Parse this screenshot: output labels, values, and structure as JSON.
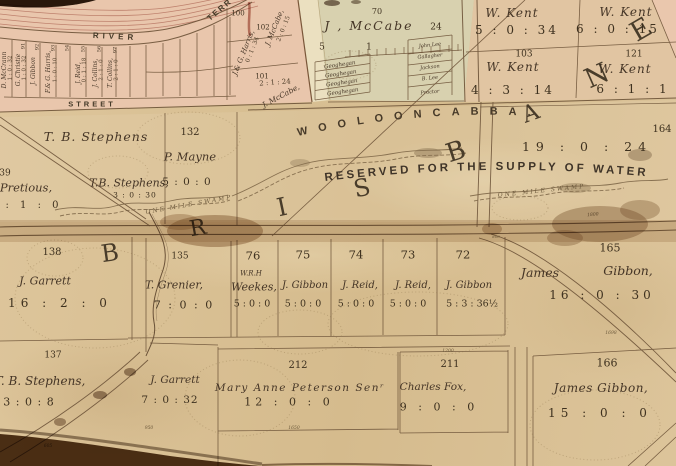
{
  "map": {
    "arc_labels": {
      "suburb": "WOOLOONCABBA.",
      "reserve": "RESERVED  FOR  THE  SUPPLY  OF  WATER",
      "swamp_left": "ONE  MILE  SWAMP",
      "swamp_right": "ONE  MILE  SWAMP"
    },
    "region_letters": [
      {
        "ch": "B",
        "x": 110,
        "y": 253,
        "r": -8,
        "fs": 24
      },
      {
        "ch": "R",
        "x": 198,
        "y": 229,
        "r": -10,
        "fs": 22
      },
      {
        "ch": "I",
        "x": 282,
        "y": 207,
        "r": -12,
        "fs": 25
      },
      {
        "ch": "S",
        "x": 362,
        "y": 188,
        "r": -12,
        "fs": 24
      },
      {
        "ch": "B",
        "x": 456,
        "y": 152,
        "r": -18,
        "fs": 26
      },
      {
        "ch": "A",
        "x": 531,
        "y": 114,
        "r": -20,
        "fs": 23
      },
      {
        "ch": "N",
        "x": 597,
        "y": 76,
        "r": -24,
        "fs": 27
      },
      {
        "ch": "E",
        "x": 641,
        "y": 30,
        "r": -30,
        "fs": 27
      }
    ],
    "labels": [
      {
        "t": "RIVER",
        "x": 115,
        "y": 37,
        "fs": 8,
        "r": 3,
        "ls": 4,
        "cls": "street",
        "n": "street-river"
      },
      {
        "t": "TERR",
        "x": 220,
        "y": 10,
        "fs": 8,
        "r": -40,
        "ls": 2,
        "cls": "street",
        "n": "street-terrace"
      },
      {
        "t": "STREET",
        "x": 92,
        "y": 104,
        "fs": 7.5,
        "ls": 3,
        "cls": "street",
        "n": "street-label"
      },
      {
        "t": "D. McCrann",
        "x": 5,
        "y": 70,
        "fs": 6,
        "r": -90,
        "cls": "owner"
      },
      {
        "t": "1 : 0 : 32",
        "x": 11,
        "y": 68,
        "fs": 5.5,
        "r": -90,
        "cls": "tiny"
      },
      {
        "t": "G. Christie",
        "x": 19,
        "y": 70,
        "fs": 6,
        "r": -90,
        "cls": "owner"
      },
      {
        "t": "1 : 0 : 32",
        "x": 25,
        "y": 68,
        "fs": 5.5,
        "r": -90,
        "cls": "tiny"
      },
      {
        "t": "91",
        "x": 24,
        "y": 46,
        "fs": 5,
        "r": -90,
        "cls": "num"
      },
      {
        "t": "J. Gibbon",
        "x": 34,
        "y": 71,
        "fs": 6,
        "r": -90,
        "cls": "owner"
      },
      {
        "t": "92",
        "x": 38,
        "y": 47,
        "fs": 5,
        "r": -90,
        "cls": "num"
      },
      {
        "t": "F.& G. Harris,",
        "x": 49,
        "y": 72,
        "fs": 6,
        "r": -90,
        "cls": "owner"
      },
      {
        "t": "1 : 0 : 10",
        "x": 56,
        "y": 70,
        "fs": 5.5,
        "r": -90,
        "cls": "tiny"
      },
      {
        "t": "93",
        "x": 54,
        "y": 48,
        "fs": 5,
        "r": -90,
        "cls": "num"
      },
      {
        "t": "54",
        "x": 68,
        "y": 48,
        "fs": 5,
        "r": -90,
        "cls": "num"
      },
      {
        "t": "J. Reid,",
        "x": 79,
        "y": 73,
        "fs": 6,
        "r": -90,
        "cls": "owner"
      },
      {
        "t": "0 : 1 : 18",
        "x": 85,
        "y": 70,
        "fs": 5.5,
        "r": -90,
        "cls": "tiny"
      },
      {
        "t": "55",
        "x": 84,
        "y": 49,
        "fs": 5,
        "r": -90,
        "cls": "num"
      },
      {
        "t": "J. Collins,",
        "x": 96,
        "y": 73,
        "fs": 6,
        "r": -90,
        "cls": "owner"
      },
      {
        "t": "2 : 1 : 0",
        "x": 102,
        "y": 70,
        "fs": 5.5,
        "r": -90,
        "cls": "tiny"
      },
      {
        "t": "56",
        "x": 100,
        "y": 49,
        "fs": 5,
        "r": -90,
        "cls": "num"
      },
      {
        "t": "T. Collins,",
        "x": 111,
        "y": 73,
        "fs": 6,
        "r": -90,
        "cls": "owner"
      },
      {
        "t": "2 : 1 : 0",
        "x": 117,
        "y": 70,
        "fs": 5.5,
        "r": -90,
        "cls": "tiny"
      },
      {
        "t": "97",
        "x": 116,
        "y": 50,
        "fs": 5,
        "r": -90,
        "cls": "num"
      },
      {
        "t": "100",
        "x": 238,
        "y": 14,
        "fs": 7,
        "cls": "num"
      },
      {
        "t": "J.& G. Harris,",
        "x": 244,
        "y": 53,
        "fs": 7,
        "r": -68,
        "cls": "owner"
      },
      {
        "t": "0 : 1 : 34",
        "x": 253,
        "y": 50,
        "fs": 6,
        "r": -68,
        "cls": "tiny"
      },
      {
        "t": "102",
        "x": 263,
        "y": 28,
        "fs": 7,
        "cls": "num"
      },
      {
        "t": "J. McCabe,",
        "x": 275,
        "y": 28,
        "fs": 7,
        "r": -68,
        "cls": "owner"
      },
      {
        "t": "2 : 0 : 15",
        "x": 284,
        "y": 29,
        "fs": 6,
        "r": -68,
        "cls": "tiny"
      },
      {
        "t": "101",
        "x": 262,
        "y": 77,
        "fs": 7,
        "cls": "num"
      },
      {
        "t": "2 : 1 : 24",
        "x": 275,
        "y": 83,
        "fs": 7,
        "r": -4,
        "cls": "tiny"
      },
      {
        "t": "J. McCabe,",
        "x": 281,
        "y": 96,
        "fs": 7.5,
        "r": -28,
        "cls": "owner"
      },
      {
        "t": "70",
        "x": 377,
        "y": 12,
        "fs": 8,
        "cls": "num"
      },
      {
        "t": "J , McCabe",
        "x": 369,
        "y": 26,
        "fs": 12.5,
        "ls": 2,
        "cls": "owner",
        "n": "j-mccabe-parcel-owner"
      },
      {
        "t": "5",
        "x": 322,
        "y": 48,
        "fs": 9,
        "cls": "num"
      },
      {
        "t": "1",
        "x": 369,
        "y": 48,
        "fs": 9,
        "cls": "num"
      },
      {
        "t": "24",
        "x": 436,
        "y": 28,
        "fs": 9,
        "cls": "num"
      },
      {
        "t": "Geoghegan",
        "x": 340,
        "y": 66,
        "fs": 5.5,
        "r": -8,
        "cls": "owner"
      },
      {
        "t": "Geoghegan",
        "x": 341,
        "y": 75,
        "fs": 5.5,
        "r": -8,
        "cls": "owner"
      },
      {
        "t": "Geoghegan",
        "x": 342,
        "y": 84,
        "fs": 5.5,
        "r": -8,
        "cls": "owner"
      },
      {
        "t": "Geoghegan",
        "x": 343,
        "y": 93,
        "fs": 5.5,
        "r": -8,
        "cls": "owner"
      },
      {
        "t": "John Lee",
        "x": 430,
        "y": 46,
        "fs": 5,
        "r": -6,
        "cls": "owner"
      },
      {
        "t": "Gallagher",
        "x": 430,
        "y": 57,
        "fs": 5,
        "r": -6,
        "cls": "owner"
      },
      {
        "t": "Jackson",
        "x": 430,
        "y": 68,
        "fs": 5,
        "r": -6,
        "cls": "owner"
      },
      {
        "t": "B. Lee",
        "x": 430,
        "y": 79,
        "fs": 5,
        "r": -6,
        "cls": "owner"
      },
      {
        "t": "Proctor",
        "x": 430,
        "y": 93,
        "fs": 5,
        "r": -6,
        "cls": "owner"
      },
      {
        "t": "W. Kent",
        "x": 512,
        "y": 13,
        "fs": 12,
        "ls": 1,
        "cls": "owner"
      },
      {
        "t": "5 : 0 : 34",
        "x": 517,
        "y": 30,
        "fs": 12,
        "ls": 3,
        "cls": "num"
      },
      {
        "t": "W. Kent",
        "x": 626,
        "y": 12,
        "fs": 12,
        "ls": 1,
        "cls": "owner"
      },
      {
        "t": "6 : 0 : 15",
        "x": 618,
        "y": 29,
        "fs": 12,
        "ls": 3,
        "cls": "num"
      },
      {
        "t": "103",
        "x": 524,
        "y": 55,
        "fs": 9,
        "cls": "num"
      },
      {
        "t": "W. Kent",
        "x": 513,
        "y": 67,
        "fs": 12,
        "ls": 1,
        "cls": "owner"
      },
      {
        "t": "4 : 3 : 14",
        "x": 513,
        "y": 90,
        "fs": 12,
        "ls": 3,
        "cls": "num"
      },
      {
        "t": "121",
        "x": 634,
        "y": 55,
        "fs": 9,
        "cls": "num"
      },
      {
        "t": "W. Kent",
        "x": 625,
        "y": 69,
        "fs": 12,
        "ls": 1,
        "cls": "owner"
      },
      {
        "t": "6 : 1 : 1",
        "x": 633,
        "y": 89,
        "fs": 12,
        "ls": 3,
        "cls": "num"
      },
      {
        "t": "T. B. Stephens",
        "x": 96,
        "y": 137,
        "fs": 12.5,
        "ls": 1,
        "cls": "owner"
      },
      {
        "t": "132",
        "x": 190,
        "y": 133,
        "fs": 10,
        "cls": "num"
      },
      {
        "t": "P. Mayne",
        "x": 190,
        "y": 157,
        "fs": 11.5,
        "cls": "owner"
      },
      {
        "t": "T.B. Stephens,",
        "x": 129,
        "y": 183,
        "fs": 11,
        "cls": "owner"
      },
      {
        "t": "5 : 0 : 0",
        "x": 187,
        "y": 182,
        "fs": 10.5,
        "ls": 1,
        "cls": "num"
      },
      {
        "t": "3 : 0 : 30",
        "x": 135,
        "y": 195,
        "fs": 7.5,
        "ls": 1,
        "cls": "num"
      },
      {
        "t": "39",
        "x": 5,
        "y": 174,
        "fs": 9,
        "cls": "num"
      },
      {
        "t": "Pretious,",
        "x": 26,
        "y": 188,
        "fs": 11.5,
        "cls": "owner"
      },
      {
        "t": ": 1 : 0",
        "x": 34,
        "y": 206,
        "fs": 10,
        "ls": 4,
        "cls": "num"
      },
      {
        "t": "164",
        "x": 662,
        "y": 130,
        "fs": 10,
        "cls": "num"
      },
      {
        "t": "19 : 0 : 24",
        "x": 587,
        "y": 147,
        "fs": 12.5,
        "ls": 6,
        "cls": "num"
      },
      {
        "t": "1800",
        "x": 593,
        "y": 216,
        "fs": 4.5,
        "r": -5,
        "cls": "dist"
      },
      {
        "t": "138",
        "x": 52,
        "y": 253,
        "fs": 10,
        "cls": "num"
      },
      {
        "t": "J. Garrett",
        "x": 45,
        "y": 281,
        "fs": 11,
        "cls": "owner"
      },
      {
        "t": "16 : 2 : 0",
        "x": 60,
        "y": 303,
        "fs": 12,
        "ls": 5,
        "cls": "num"
      },
      {
        "t": "135",
        "x": 180,
        "y": 257,
        "fs": 9,
        "cls": "num"
      },
      {
        "t": "T. Grenier,",
        "x": 174,
        "y": 285,
        "fs": 11,
        "cls": "owner"
      },
      {
        "t": "7 : 0 : 0",
        "x": 184,
        "y": 305,
        "fs": 11,
        "ls": 2,
        "cls": "num"
      },
      {
        "t": "76",
        "x": 253,
        "y": 256,
        "fs": 11.5,
        "cls": "num"
      },
      {
        "t": "75",
        "x": 303,
        "y": 255,
        "fs": 11.5,
        "cls": "num"
      },
      {
        "t": "74",
        "x": 356,
        "y": 255,
        "fs": 11.5,
        "cls": "num"
      },
      {
        "t": "73",
        "x": 408,
        "y": 255,
        "fs": 11.5,
        "cls": "num"
      },
      {
        "t": "72",
        "x": 463,
        "y": 255,
        "fs": 11.5,
        "cls": "num"
      },
      {
        "t": "W.R.H",
        "x": 251,
        "y": 274,
        "fs": 7,
        "cls": "owner"
      },
      {
        "t": "Weekes,",
        "x": 254,
        "y": 287,
        "fs": 11,
        "cls": "owner"
      },
      {
        "t": "J. Gibbon",
        "x": 305,
        "y": 286,
        "fs": 10,
        "cls": "owner"
      },
      {
        "t": "J. Reid,",
        "x": 360,
        "y": 286,
        "fs": 10,
        "cls": "owner"
      },
      {
        "t": "J. Reid,",
        "x": 413,
        "y": 286,
        "fs": 10,
        "cls": "owner"
      },
      {
        "t": "J. Gibbon",
        "x": 469,
        "y": 286,
        "fs": 10,
        "cls": "owner"
      },
      {
        "t": "5 : 0 : 0",
        "x": 252,
        "y": 304,
        "fs": 9.5,
        "cls": "num"
      },
      {
        "t": "5 : 0 : 0",
        "x": 303,
        "y": 304,
        "fs": 9.5,
        "cls": "num"
      },
      {
        "t": "5 : 0 : 0",
        "x": 356,
        "y": 304,
        "fs": 9.5,
        "cls": "num"
      },
      {
        "t": "5 : 0 : 0",
        "x": 408,
        "y": 304,
        "fs": 9.5,
        "cls": "num"
      },
      {
        "t": "5 : 3 : 36½",
        "x": 472,
        "y": 304,
        "fs": 9.5,
        "cls": "num"
      },
      {
        "t": "800",
        "x": 496,
        "y": 237,
        "fs": 4,
        "cls": "dist"
      },
      {
        "t": "165",
        "x": 610,
        "y": 248,
        "fs": 11,
        "cls": "num"
      },
      {
        "t": "James",
        "x": 540,
        "y": 273,
        "fs": 12.5,
        "cls": "owner"
      },
      {
        "t": "Gibbon,",
        "x": 628,
        "y": 271,
        "fs": 12.5,
        "cls": "owner"
      },
      {
        "t": "16 : 0 : 30",
        "x": 602,
        "y": 295,
        "fs": 12,
        "ls": 4,
        "cls": "num"
      },
      {
        "t": "1698",
        "x": 611,
        "y": 334,
        "fs": 4.5,
        "cls": "dist"
      },
      {
        "t": "137",
        "x": 53,
        "y": 356,
        "fs": 9,
        "cls": "num"
      },
      {
        "t": "T. B. Stephens,",
        "x": 40,
        "y": 381,
        "fs": 12,
        "cls": "owner"
      },
      {
        "t": "3 : 0 : 8",
        "x": 29,
        "y": 402,
        "fs": 11,
        "ls": 1,
        "cls": "num"
      },
      {
        "t": "605",
        "x": 48,
        "y": 447,
        "fs": 4.5,
        "cls": "dist"
      },
      {
        "t": "J. Garrett",
        "x": 175,
        "y": 380,
        "fs": 10.5,
        "cls": "owner"
      },
      {
        "t": "7 : 0 : 32",
        "x": 170,
        "y": 400,
        "fs": 10.5,
        "ls": 1,
        "cls": "num"
      },
      {
        "t": "950",
        "x": 149,
        "y": 429,
        "fs": 4.5,
        "cls": "dist"
      },
      {
        "t": "212",
        "x": 298,
        "y": 366,
        "fs": 10,
        "cls": "num"
      },
      {
        "t": "Mary Anne Peterson Senʳ",
        "x": 300,
        "y": 388,
        "fs": 10.5,
        "ls": 1.5,
        "cls": "owner"
      },
      {
        "t": "12 : 0 : 0",
        "x": 289,
        "y": 402,
        "fs": 11,
        "ls": 4,
        "cls": "num"
      },
      {
        "t": "1650",
        "x": 294,
        "y": 429,
        "fs": 4.5,
        "cls": "dist"
      },
      {
        "t": "1200",
        "x": 448,
        "y": 352,
        "fs": 4.5,
        "cls": "dist"
      },
      {
        "t": "211",
        "x": 450,
        "y": 365,
        "fs": 10,
        "cls": "num"
      },
      {
        "t": "Charles Fox,",
        "x": 433,
        "y": 387,
        "fs": 10.5,
        "cls": "owner"
      },
      {
        "t": "9 : 0 : 0",
        "x": 439,
        "y": 407,
        "fs": 11,
        "ls": 4,
        "cls": "num"
      },
      {
        "t": "166",
        "x": 607,
        "y": 363,
        "fs": 11,
        "cls": "num"
      },
      {
        "t": "James Gibbon,",
        "x": 601,
        "y": 388,
        "fs": 12,
        "ls": 0.5,
        "cls": "owner"
      },
      {
        "t": "15 : 0 : 0",
        "x": 600,
        "y": 413,
        "fs": 12,
        "ls": 5,
        "cls": "num"
      }
    ]
  }
}
